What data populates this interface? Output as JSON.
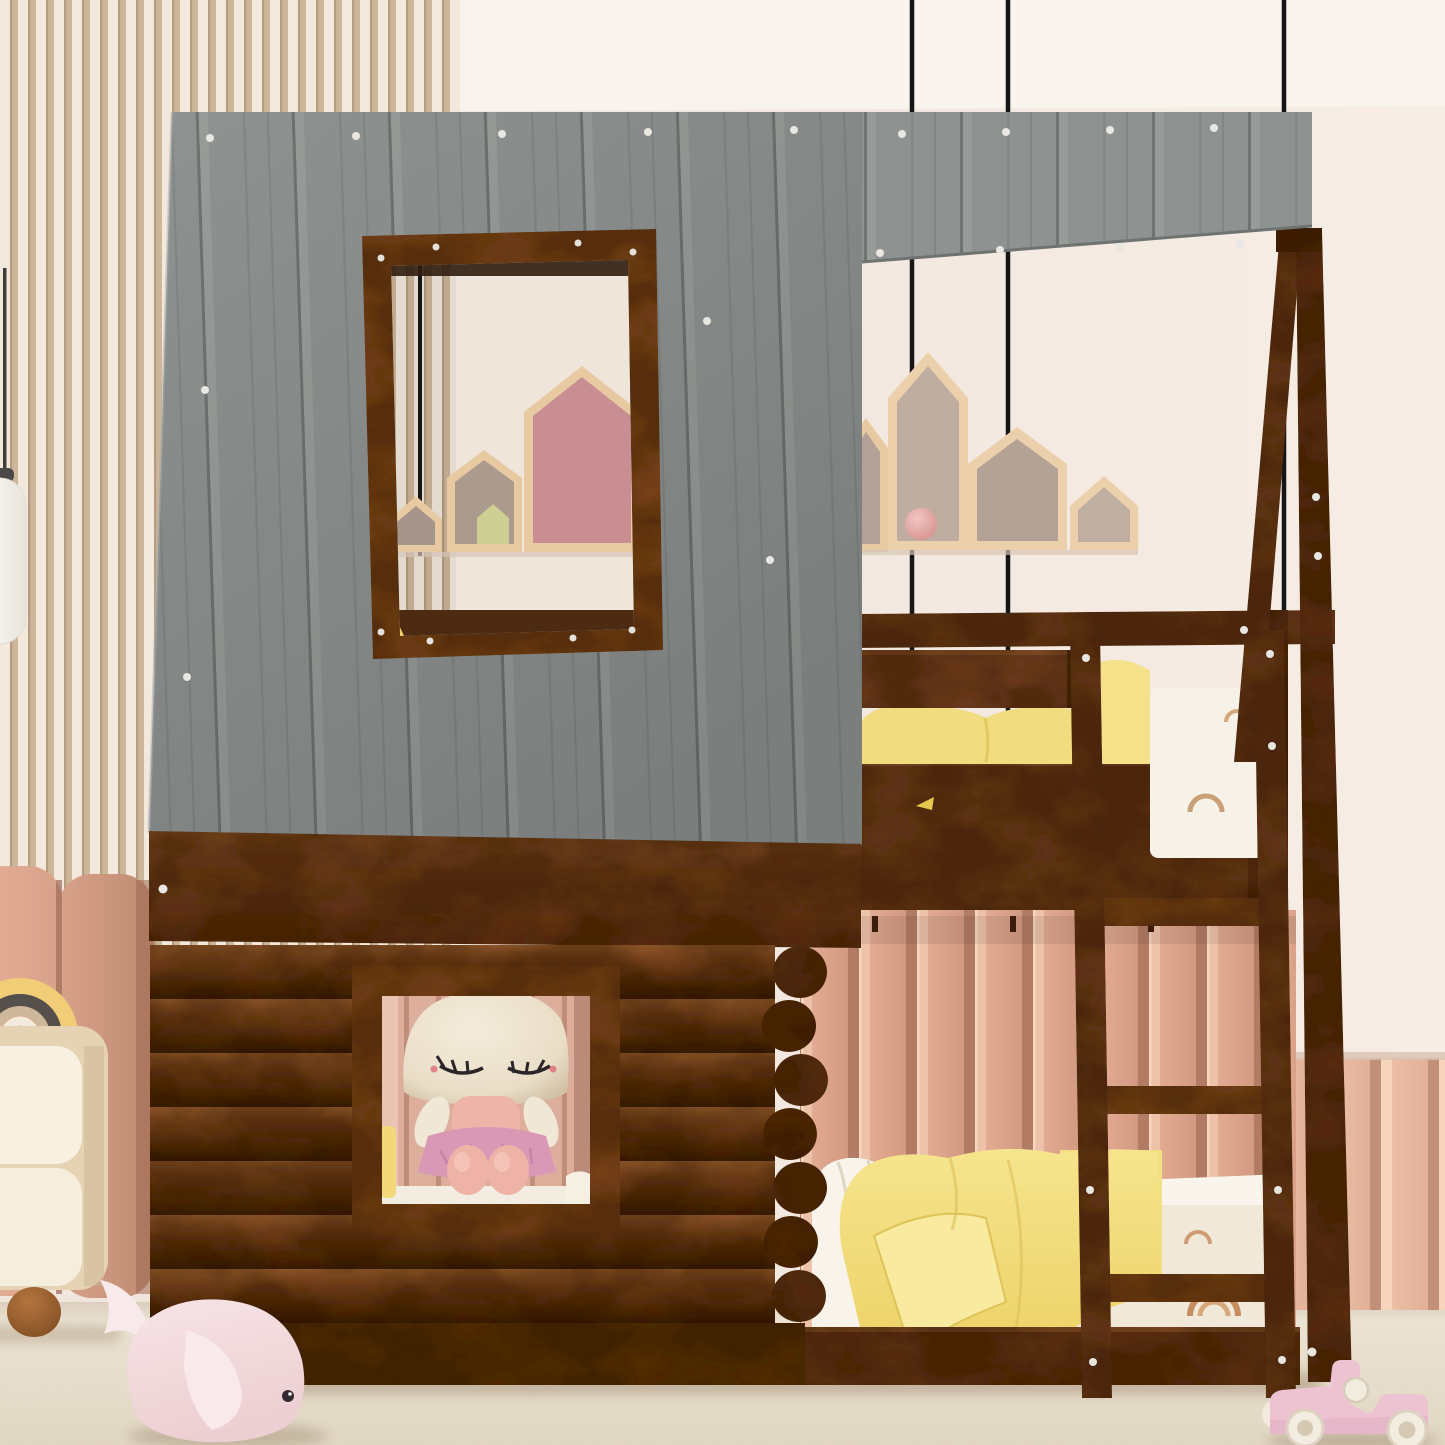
{
  "scene": {
    "kind": "product-photo",
    "subject": "house-shaped twin-over-twin bunk bed with gray plank roof, rustic log-cabin lower wall, two windows and a front ladder",
    "setting": "children's bedroom with slatted wood wall, pink pleated wall panels, house-shaped wall shelves, plush toys and a cream carpet"
  },
  "palette": {
    "wall": "#f2e8df",
    "ceiling": "#f8f4ed",
    "roof_gray": "#8e9290",
    "walnut": "#6b3a1c",
    "walnut_dark": "#5a2f12",
    "log_brown": "#7b4520",
    "slat_light": "#f2e9dc",
    "slat_dark": "#cdb69a",
    "pleat_pink": "#e0a88f",
    "pleat_pink_light": "#ecbfa6",
    "floor": "#ece4d4",
    "blanket_yellow": "#f3df7f",
    "mattress_white": "#f7f2e7",
    "shelf_wood": "#e7c9a2",
    "house_pink": "#c98d94",
    "house_olive": "#ced093",
    "cable_black": "#161616",
    "ball_pink": "#e2a7a4",
    "whale_pink": "#f3dbdd",
    "car_pink": "#edc3d2",
    "lamp_white": "#fdfcf9",
    "nightstand_cream": "#f7f0df",
    "nightstand_frame": "#e6d3b4",
    "rainbow_yellow": "#f2cd78",
    "doll_head": "#efe5d2",
    "doll_body": "#eeb4a8",
    "doll_skirt": "#d998b6"
  },
  "objects": {
    "bed": "house bunk bed, walnut finish",
    "roof": "gray washed plank roof with white screws",
    "upper_window": "open roof window framed in walnut",
    "lower_window": "square log-wall window with plush doll inside",
    "ladder": "three-rung front ladder",
    "a_frame": "angled walnut A-frame posts on the right",
    "top_bunk": "yellow pillows and white rainbow-print mattress",
    "bottom_bunk": "yellow blanket, white pillow and rainbow-print mattress",
    "shelves": "house-shaped wall shelves with pink ball and small doll",
    "toys": "pink plush whale on floor, pink wooden toy car",
    "furniture": "cream nightstand with rainbow stacker toy, white pendant lamp"
  }
}
